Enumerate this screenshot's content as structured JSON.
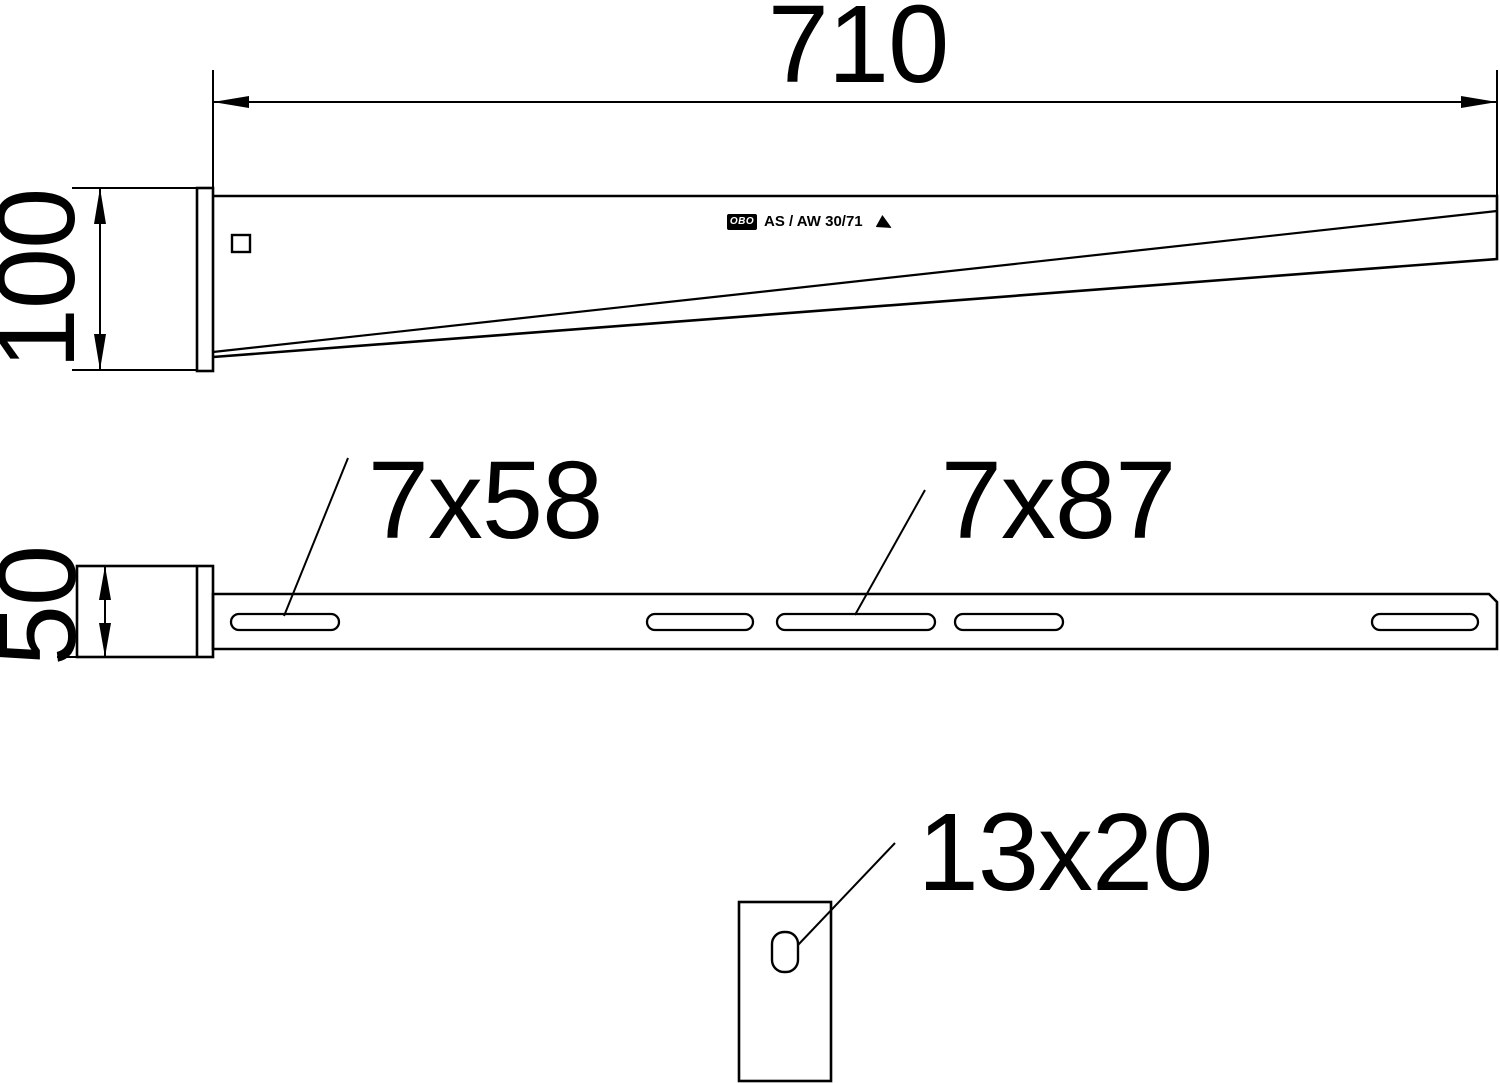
{
  "page": {
    "background_color": "#ffffff",
    "line_color": "#000000",
    "description": "Technical dimension drawing of an OBO wall and support bracket, three views: side elevation, plan view, hole detail"
  },
  "branding": {
    "logo_text": "OBO",
    "model_label": "AS / AW 30/71"
  },
  "side_view": {
    "length_dim_label": "710",
    "height_dim_label": "100",
    "has_square_hole": true
  },
  "plan_view": {
    "width_dim_label": "50",
    "slot_callout_small": "7x58",
    "slot_callout_large": "7x87",
    "slots": [
      {
        "x": 231,
        "y": 614,
        "w": 108,
        "h": 16,
        "type": "7x58"
      },
      {
        "x": 647,
        "y": 614,
        "w": 106,
        "h": 16,
        "type": "7x58"
      },
      {
        "x": 777,
        "y": 614,
        "w": 158,
        "h": 16,
        "type": "7x87"
      },
      {
        "x": 955,
        "y": 614,
        "w": 108,
        "h": 16,
        "type": "7x58"
      },
      {
        "x": 1372,
        "y": 614,
        "w": 106,
        "h": 16,
        "type": "7x58"
      }
    ]
  },
  "detail_view": {
    "hole_callout": "13x20"
  }
}
